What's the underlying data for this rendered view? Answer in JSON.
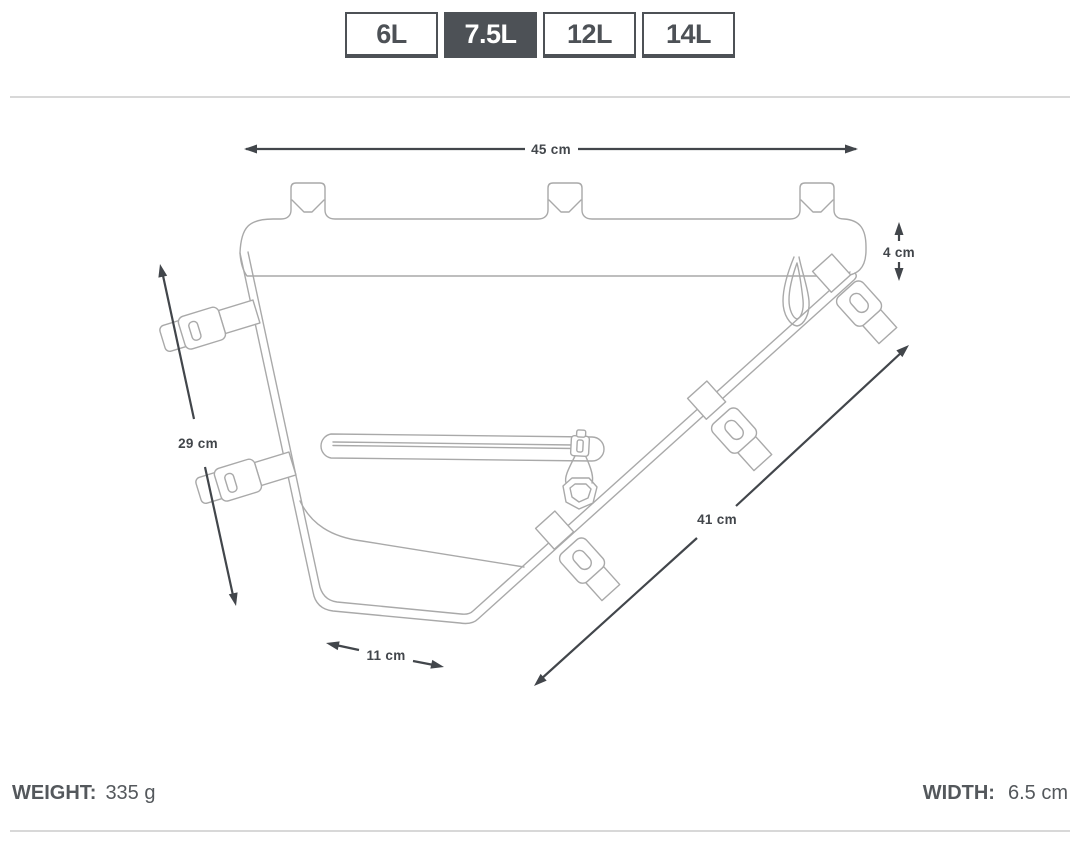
{
  "size_selector": {
    "options": [
      {
        "label": "6L",
        "selected": false
      },
      {
        "label": "7.5L",
        "selected": true
      },
      {
        "label": "12L",
        "selected": false
      },
      {
        "label": "14L",
        "selected": false
      }
    ]
  },
  "diagram": {
    "description": "line drawing of triangular bike frame pack with straps, zipper and dimension arrows",
    "dimensions": {
      "top_width": "45 cm",
      "rear_height": "4 cm",
      "front_height": "29 cm",
      "bottom_diagonal": "41 cm",
      "base_width": "11 cm"
    }
  },
  "specs": {
    "weight_label": "WEIGHT:",
    "weight_value": "335 g",
    "width_label": "WIDTH:",
    "width_value": "6.5 cm"
  },
  "colors": {
    "accent": "#4d5156",
    "selected_tab_bg": "#4d5156",
    "selected_tab_text": "#ffffff",
    "drawing_line": "#a9a9a9",
    "dimension_line": "#42464b",
    "divider": "#d8d8d8"
  }
}
